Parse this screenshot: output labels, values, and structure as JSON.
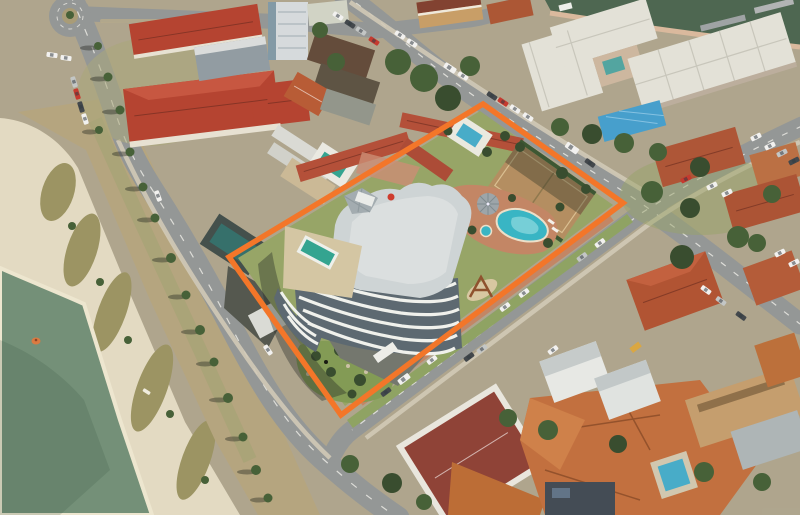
{
  "meta": {
    "type": "oblique-aerial-photograph",
    "subject": "Beachfront apartment complex site outlined in orange for marketing",
    "canvas": {
      "width": 800,
      "height": 515
    }
  },
  "colors": {
    "ground": "#aba28b",
    "water": "#6d8c74",
    "water_deep": "#5e806c",
    "canal": "#45604b",
    "sand": "#e2dac2",
    "wet_sand": "#ede6d0",
    "dune": "#97905e",
    "road": "#8f9394",
    "road_mark": "#eaeae6",
    "footpath": "#cfc8b6",
    "grass": "#8aa05e",
    "lawn_bright": "#92a263",
    "tree": "#3e5a31",
    "tree_dark": "#2f4527",
    "red_roof": "#b13c2a",
    "motel_roof": "#b04832",
    "tile_roof": "#bf6a38",
    "white_roof": "#e2e1d8",
    "grey_roof": "#b4bcbf",
    "tower_roof": "#ccd3d6",
    "tower_wall": "#f0f2ef",
    "glass": "#55636d",
    "podium": "#d2c5a2",
    "pool_teal": "#2aa18e",
    "pool_blue": "#2fb3c4",
    "pool_small": "#3fa9c9",
    "tennis": "#b08a5c",
    "paving": "#c08160",
    "gazebo": "#98a2a8",
    "tarp": "#3e9bcd",
    "shadow": "rgba(25,32,28,0.38)",
    "boundary": "#f37021",
    "buoy": "#d8743a",
    "car_white": "#f2f2f2",
    "car_silver": "#c0c4c6",
    "car_dark": "#394046",
    "car_red": "#c23128",
    "car_yellow": "#d9a43c"
  },
  "boundary": {
    "label": "property-outline",
    "points": "483,104 623,203 341,415 229,257",
    "stroke_width": 5.5
  },
  "scene": {
    "water_body": "sea-foreshore",
    "beach": "sand-beach",
    "canal": "canal-waterway",
    "property": "apartment-tower-with-motel-wings-pool-and-tennis-court",
    "landmarks": [
      "roundabout",
      "esplanade",
      "street-intersection",
      "jetties",
      "lagoon-pool",
      "tennis-court",
      "rooftop-pool"
    ]
  }
}
